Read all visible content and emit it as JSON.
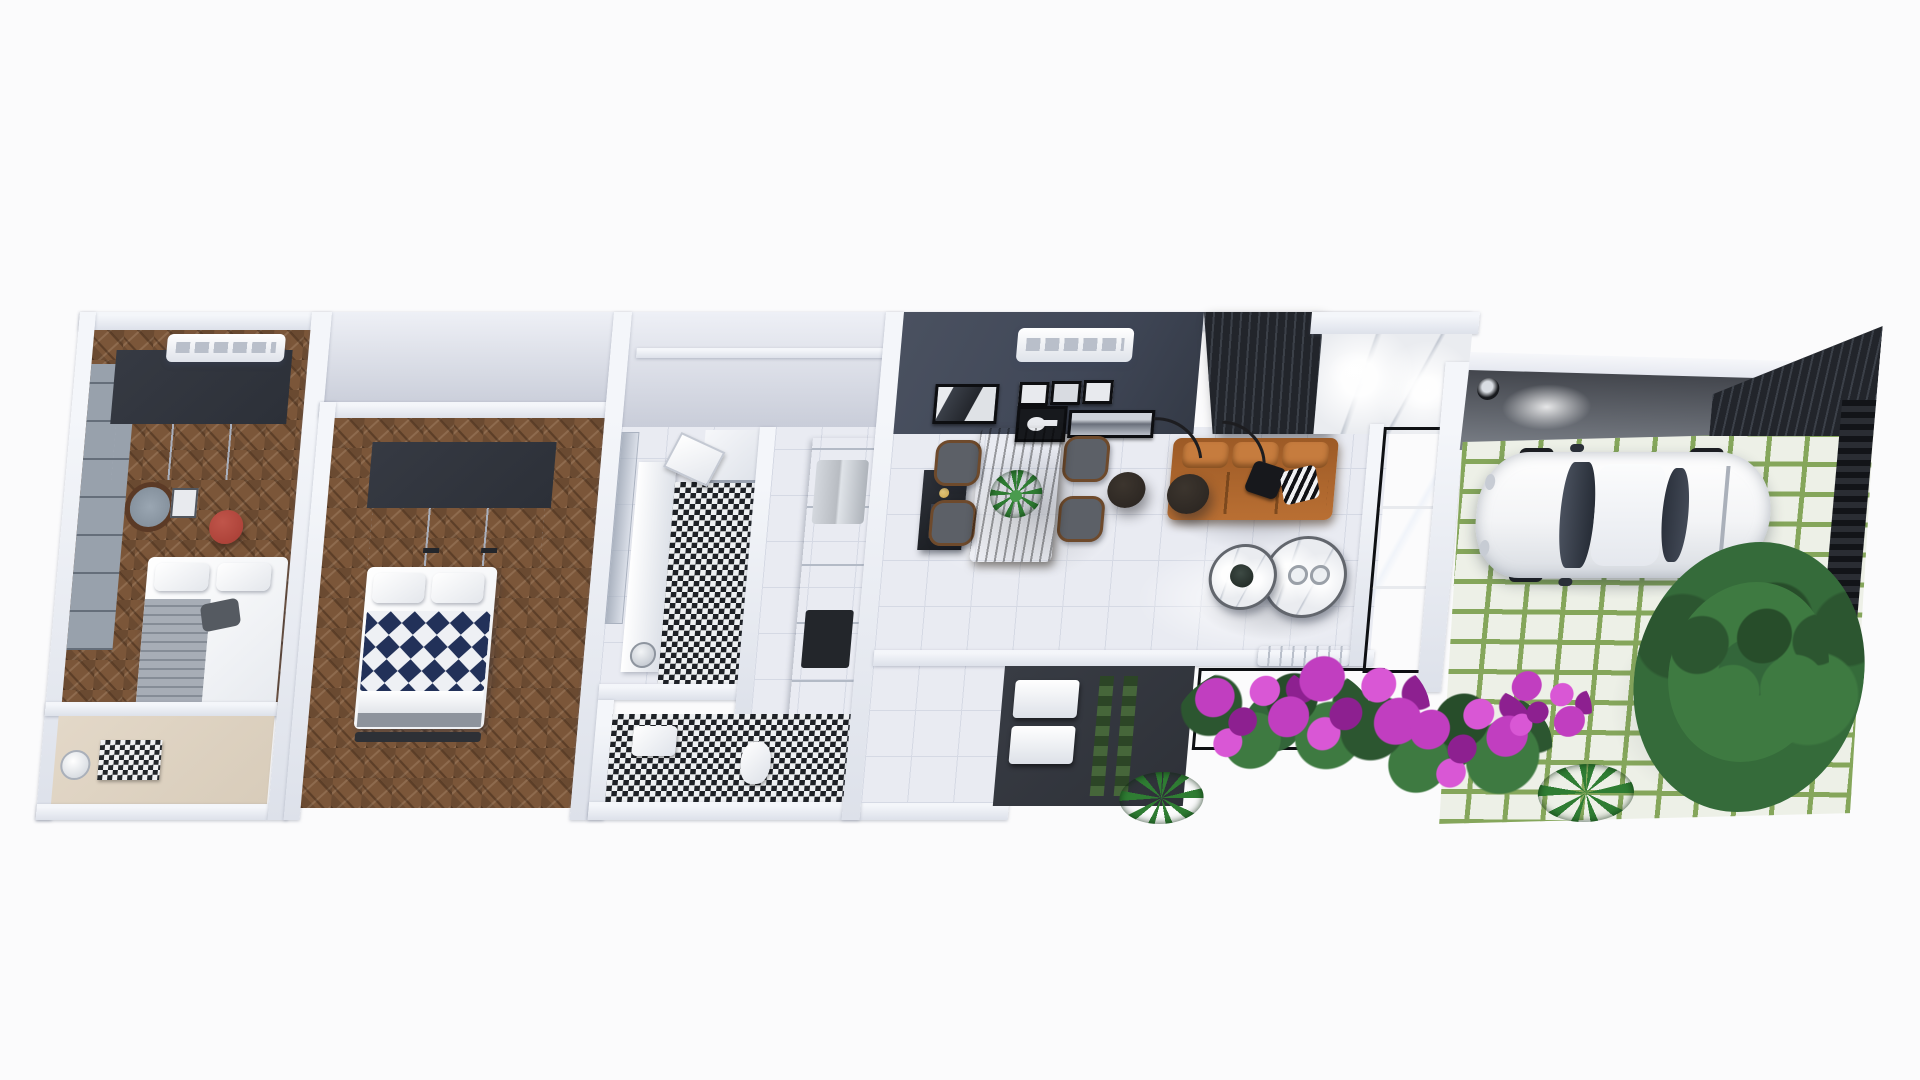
{
  "scene": {
    "type": "3d-floor-plan-render",
    "view": "top-down-dollhouse",
    "background": "white",
    "style": "modern-narrow-house"
  },
  "palette": {
    "bg": "#fbfbfc",
    "wall": "#f4f6fa",
    "wall-shade": "#dde1ea",
    "dark-panel": "#2c3038",
    "cabinet": "#d9dde4",
    "accent-wall": "#404757",
    "slat": "#22252b",
    "slat-line": "#3b4048",
    "tile": "#e9ebf2",
    "tile-line": "#d5d9e4",
    "wood-mid": "#7b5639",
    "wood-dark": "#5a3c26",
    "mosaic-dark": "#1e2126",
    "navy": "#223159",
    "beige": "#d8ccba",
    "sofa": "#b96f33",
    "sofa-light": "#c67c3e",
    "lamp": "#28231f",
    "marble": "#eaecf0",
    "glass": "#1a1d22",
    "paver": "#edf0e7",
    "grass": "#85a65b",
    "tree-dark": "#2c5630",
    "tree-mid": "#3e7a41",
    "flower": "#c13ec0",
    "flower-deep": "#8d2090",
    "ottoman-red": "#a63c33",
    "steel": "#b8bcc2",
    "gold": "#c9a24a",
    "chair": "#5c6067",
    "chair-wood": "#6e4a2c",
    "plant": "#2f7d33",
    "car-body": "#f3f4f6",
    "dark-floor": "#2e3138"
  },
  "rooms": {
    "bedroom1": {
      "name": "bedroom-1",
      "floor": "herringbone-wood",
      "furniture": [
        "dark-wardrobe",
        "ac-unit",
        "round-wall-mirror",
        "red-ottoman",
        "double-bed-grey-white",
        "grey-panel-wall"
      ]
    },
    "laundry": {
      "name": "laundry-room",
      "floor": "beige",
      "furniture": [
        "checker-rug",
        "round-basin"
      ]
    },
    "bedroom2": {
      "name": "bedroom-2",
      "floor": "herringbone-wood",
      "furniture": [
        "dark-wardrobe",
        "double-bed-chevron-duvet",
        "foot-bench"
      ]
    },
    "bathroom1": {
      "name": "bathroom",
      "floor": "bw-mosaic",
      "furniture": [
        "white-vanity",
        "chrome-basin",
        "shower",
        "glass-door",
        "open-door"
      ]
    },
    "hallway": {
      "name": "hallway-kitchen-run",
      "floor": "white-tile",
      "furniture": [
        "tall-cabinets",
        "steel-fridge",
        "dark-cooktop"
      ]
    },
    "bathroom2": {
      "name": "service-bathroom",
      "floor": "bw-mosaic",
      "furniture": [
        "white-fixtures"
      ]
    },
    "dining": {
      "name": "kitchen-dining",
      "floor": "white-tile",
      "furniture": [
        "dark-accent-wall",
        "ac-unit",
        "palm-art-frame",
        "small-frames-x3",
        "guitar-art-frame",
        "landscape-art-frame",
        "black-island-gold-faucet",
        "live-edge-wood-table",
        "grey-dining-chairs-x4",
        "potted-plant"
      ]
    },
    "living": {
      "name": "living-room",
      "floor": "glossy-white-tile",
      "furniture": [
        "slatted-tv-panel",
        "marble-feature-wall",
        "ceiling-spotlights",
        "tan-leather-sofa",
        "black-cushion",
        "zebra-cushion",
        "arc-floor-lamps-x2",
        "marble-nesting-coffee-tables-x2",
        "glass-wall",
        "wall-heater"
      ]
    },
    "serviceYard": {
      "name": "service-yard",
      "floor": "dark-paving",
      "furniture": [
        "outdoor-units-x2",
        "hedge-strips"
      ]
    },
    "garden": {
      "name": "garden-bed",
      "planting": [
        "bougainvillea-magenta",
        "green-foliage",
        "ferns"
      ]
    },
    "garage": {
      "name": "garage-patio",
      "floor": "grass-joint-pavers",
      "furniture": [
        "white-car",
        "wall-lamp",
        "slatted-gate",
        "large-tree",
        "dark-fence"
      ]
    }
  },
  "counts": {
    "dining_chairs": 4,
    "arc_lamps": 2,
    "coffee_tables": 2,
    "bedrooms": 2,
    "ac_units": 2,
    "cars": 1
  }
}
